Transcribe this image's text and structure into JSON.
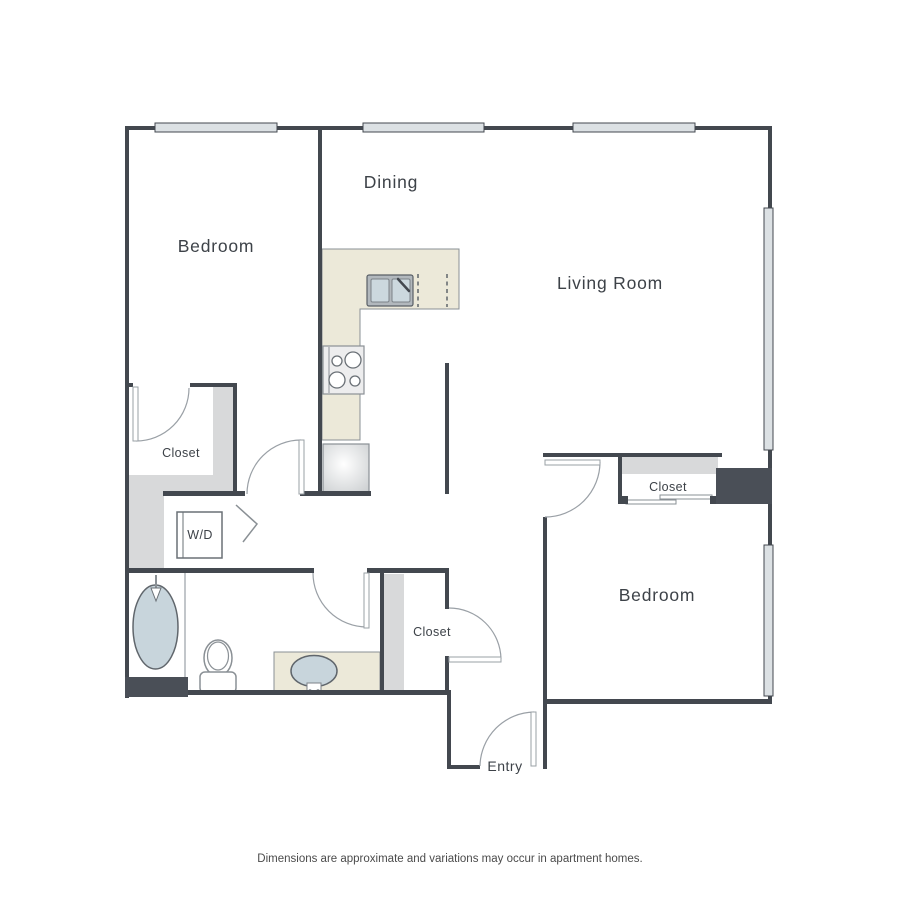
{
  "floorplan": {
    "labels": {
      "bedroom_top": "Bedroom",
      "dining": "Dining",
      "living_room": "Living Room",
      "closet_left": "Closet",
      "washer_dryer": "W/D",
      "closet_entry": "Closet",
      "closet_bedroom2": "Closet",
      "bedroom_bottom": "Bedroom",
      "entry": "Entry"
    },
    "disclaimer": "Dimensions are approximate and variations may occur in apartment homes.",
    "colors": {
      "wall": "#43484f",
      "window_fill": "#dce1e4",
      "door_swing": "#9aa0a6",
      "counter_cream": "#ece9d9",
      "closet_shelf_gray": "#d8d9da",
      "fixture_blue": "#c8d5dc",
      "label_text": "#3d4248",
      "disclaimer_text": "#4b4b4b"
    }
  }
}
